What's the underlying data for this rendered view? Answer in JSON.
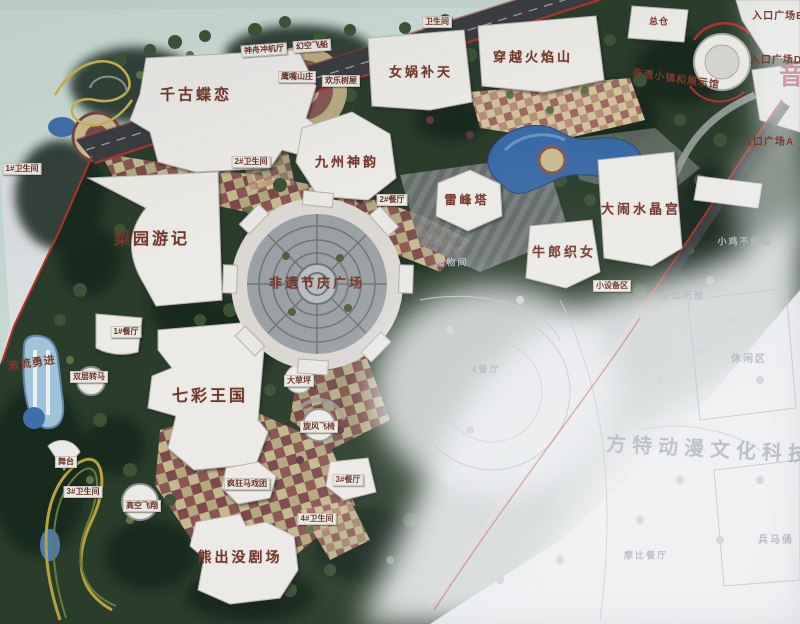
{
  "scene": {
    "description": "Photograph of a theme park master plan map on a display board; lower-right portion washed out by light glare showing a faint neighbouring park",
    "colors": {
      "accent_red": "#b5312c",
      "water_blue": "#3a6aa6",
      "label_brown": "#6b3226",
      "faint_gray": "#b5b9c0",
      "tile_tan": "#c9bc92",
      "tile_maroon": "#7c4a4a",
      "forest_green": "#263827",
      "outside_board": "#ccdcd6"
    }
  },
  "map": {
    "watermark_text": "方特动漫文化科技",
    "labels": [
      {
        "id": "qian-gu-die-lian",
        "text": "千古蝶恋",
        "x": 196,
        "y": 95,
        "fs": 15,
        "type": "major"
      },
      {
        "id": "nv-wa-bu-tian",
        "text": "女娲补天",
        "x": 421,
        "y": 72,
        "fs": 13,
        "type": "major"
      },
      {
        "id": "chuan-yue-huo-yan-shan",
        "text": "穿越火焰山",
        "x": 533,
        "y": 57,
        "fs": 13,
        "type": "major"
      },
      {
        "id": "jiu-zhou-shen-yun",
        "text": "九州神韵",
        "x": 347,
        "y": 162,
        "fs": 13,
        "type": "major"
      },
      {
        "id": "lei-feng-ta",
        "text": "雷峰塔",
        "x": 467,
        "y": 200,
        "fs": 12,
        "type": "major"
      },
      {
        "id": "da-nao-shui-jing-gong",
        "text": "大闹水晶宫",
        "x": 641,
        "y": 209,
        "fs": 13,
        "type": "major"
      },
      {
        "id": "niu-lang-zhi-nv",
        "text": "牛郎织女",
        "x": 564,
        "y": 252,
        "fs": 13,
        "type": "major"
      },
      {
        "id": "li-yuan-you-ji",
        "text": "梨园游记",
        "x": 152,
        "y": 240,
        "fs": 16,
        "type": "major"
      },
      {
        "id": "fei-yi-jie-qing-guang-chang",
        "text": "非遗节庆广场",
        "x": 317,
        "y": 283,
        "fs": 13,
        "type": "major"
      },
      {
        "id": "qi-cai-wang-guo",
        "text": "七彩王国",
        "x": 210,
        "y": 397,
        "fs": 16,
        "type": "major"
      },
      {
        "id": "xiong-chu-mo-ju-chang",
        "text": "熊出没剧场",
        "x": 240,
        "y": 557,
        "fs": 14,
        "type": "major"
      },
      {
        "id": "zong-cang",
        "text": "总仓",
        "x": 659,
        "y": 22,
        "fs": 9,
        "type": "plain"
      },
      {
        "id": "fei-yi-xiao-zhen",
        "text": "非遗小镇和展示馆",
        "x": 676,
        "y": 80,
        "fs": 10,
        "type": "plain",
        "rot": 8
      },
      {
        "id": "ji-liu-yong-jin",
        "text": "激流勇进",
        "x": 32,
        "y": 364,
        "fs": 11,
        "type": "plain",
        "rot": -8
      },
      {
        "id": "entrance-plaza-e",
        "text": "入口广场E",
        "x": 778,
        "y": 17,
        "fs": 10,
        "type": "plain"
      },
      {
        "id": "entrance-plaza-d",
        "text": "入口广场D",
        "x": 776,
        "y": 61,
        "fs": 10,
        "type": "plain"
      },
      {
        "id": "entrance-plaza-a",
        "text": "入口广场A",
        "x": 768,
        "y": 143,
        "fs": 10,
        "type": "plain"
      },
      {
        "id": "xiao-she-bei-qu",
        "text": "小设备区",
        "x": 612,
        "y": 286,
        "fs": 8,
        "type": "chip"
      },
      {
        "id": "music-sign",
        "text": "音",
        "x": 791,
        "y": 77,
        "fs": 24,
        "type": "sign"
      },
      {
        "id": "shen-zhou-chong-ji-ting",
        "text": "神舟冲机厅",
        "x": 264,
        "y": 50,
        "fs": 8,
        "type": "chip",
        "rot": -4
      },
      {
        "id": "huan-kong-fei-chuan",
        "text": "幻空飞船",
        "x": 312,
        "y": 46,
        "fs": 8,
        "type": "chip",
        "rot": -4
      },
      {
        "id": "ying-zui-shan-zhuang",
        "text": "鹰嘴山庄",
        "x": 297,
        "y": 77,
        "fs": 8,
        "type": "chip"
      },
      {
        "id": "huan-le-shu-wu",
        "text": "欢乐树屋",
        "x": 341,
        "y": 81,
        "fs": 8,
        "type": "chip"
      },
      {
        "id": "restroom-top",
        "text": "卫生间",
        "x": 437,
        "y": 22,
        "fs": 8,
        "type": "chip"
      },
      {
        "id": "restroom-2",
        "text": "2#卫生间",
        "x": 251,
        "y": 162,
        "fs": 8,
        "type": "chip"
      },
      {
        "id": "restroom-1",
        "text": "1#卫生间",
        "x": 22,
        "y": 169,
        "fs": 8,
        "type": "chip"
      },
      {
        "id": "restaurant-2",
        "text": "2#餐厅",
        "x": 392,
        "y": 200,
        "fs": 8,
        "type": "chip"
      },
      {
        "id": "restaurant-1",
        "text": "1#餐厅",
        "x": 126,
        "y": 332,
        "fs": 8,
        "type": "chip"
      },
      {
        "id": "shuang-ceng-zhuan-ma",
        "text": "双层转马",
        "x": 89,
        "y": 377,
        "fs": 8,
        "type": "chip"
      },
      {
        "id": "wu-tai",
        "text": "舞台",
        "x": 66,
        "y": 462,
        "fs": 8,
        "type": "chip"
      },
      {
        "id": "restroom-3",
        "text": "3#卫生间",
        "x": 83,
        "y": 492,
        "fs": 8,
        "type": "chip"
      },
      {
        "id": "gao-kong-fei-xiang",
        "text": "高空飞翔",
        "x": 142,
        "y": 506,
        "fs": 8,
        "type": "chip"
      },
      {
        "id": "feng-kuang-ma-xi-tuan",
        "text": "疯狂马戏团",
        "x": 247,
        "y": 484,
        "fs": 8,
        "type": "chip"
      },
      {
        "id": "da-cao-ping",
        "text": "大草坪",
        "x": 299,
        "y": 381,
        "fs": 8,
        "type": "chip"
      },
      {
        "id": "xuan-feng-fei-yi",
        "text": "旋风飞椅",
        "x": 319,
        "y": 427,
        "fs": 8,
        "type": "chip"
      },
      {
        "id": "restaurant-3",
        "text": "3#餐厅",
        "x": 348,
        "y": 480,
        "fs": 8,
        "type": "chip"
      },
      {
        "id": "restroom-4",
        "text": "4#卫生间",
        "x": 317,
        "y": 519,
        "fs": 8,
        "type": "chip"
      },
      {
        "id": "chu-wu-jian",
        "text": "储物间",
        "x": 452,
        "y": 263,
        "fs": 9,
        "type": "faint"
      },
      {
        "id": "restaurant-4-faint",
        "text": "4餐厅",
        "x": 486,
        "y": 370,
        "fs": 9,
        "type": "faint"
      },
      {
        "id": "xiu-xian-qu",
        "text": "休闲区",
        "x": 749,
        "y": 360,
        "fs": 10,
        "type": "faint"
      },
      {
        "id": "mo-bi-li-xian",
        "text": "摩比历险",
        "x": 683,
        "y": 296,
        "fs": 9,
        "type": "faint"
      },
      {
        "id": "xiao-ji-bu-hao-re",
        "text": "小鸡不好惹",
        "x": 745,
        "y": 242,
        "fs": 9,
        "type": "faint"
      },
      {
        "id": "mo-bi-can-ting",
        "text": "摩比餐厅",
        "x": 646,
        "y": 556,
        "fs": 9,
        "type": "faint"
      },
      {
        "id": "bing-ma-yong",
        "text": "兵马俑",
        "x": 776,
        "y": 541,
        "fs": 10,
        "type": "faint"
      },
      {
        "id": "park-watermark",
        "text": "方特动漫文化科技",
        "x": 710,
        "y": 450,
        "fs": 20,
        "type": "watermark",
        "rot": 3
      }
    ]
  }
}
